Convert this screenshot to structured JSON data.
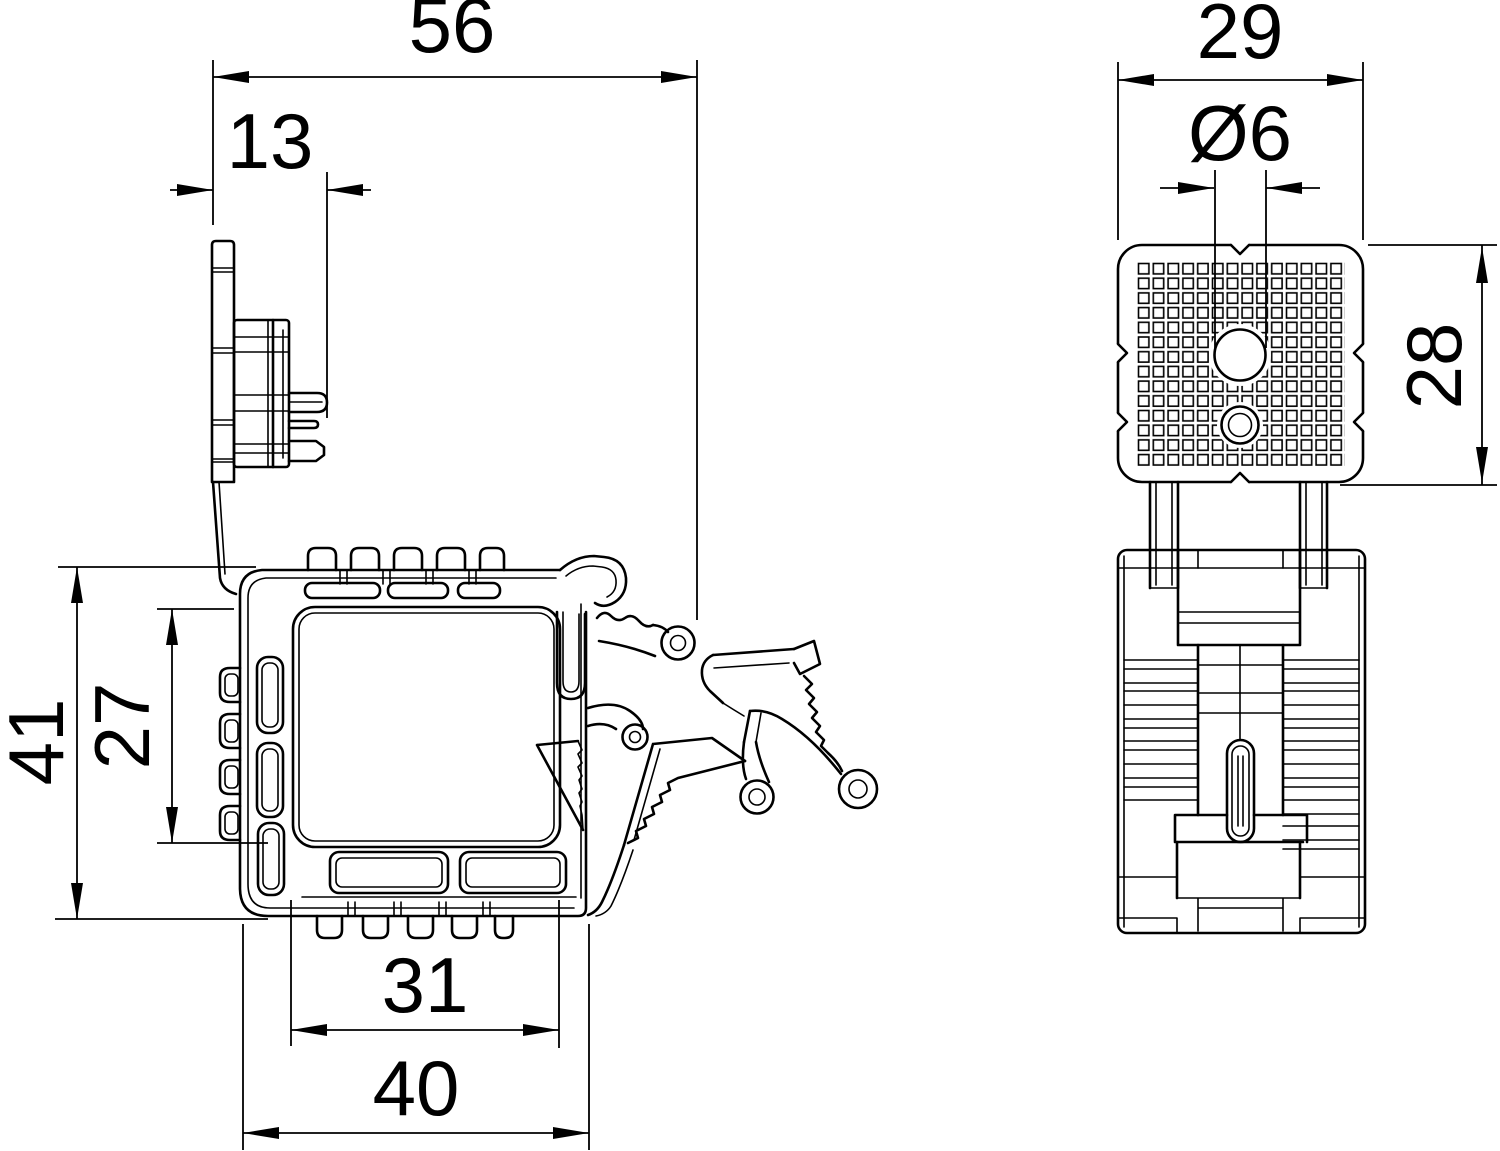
{
  "drawing": {
    "type": "technical-dimension-drawing",
    "background": "#ffffff",
    "line_color": "#000000",
    "front_view": {
      "name": "front-profile-view",
      "dims": {
        "overall_width": "56",
        "plate_offset": "13",
        "overall_height": "41",
        "opening_height": "27",
        "inner_width": "31",
        "outer_width": "40"
      }
    },
    "side_view": {
      "name": "side-view",
      "dims": {
        "width": "29",
        "hole_diameter": "Ø6",
        "plate_height": "28"
      }
    }
  }
}
